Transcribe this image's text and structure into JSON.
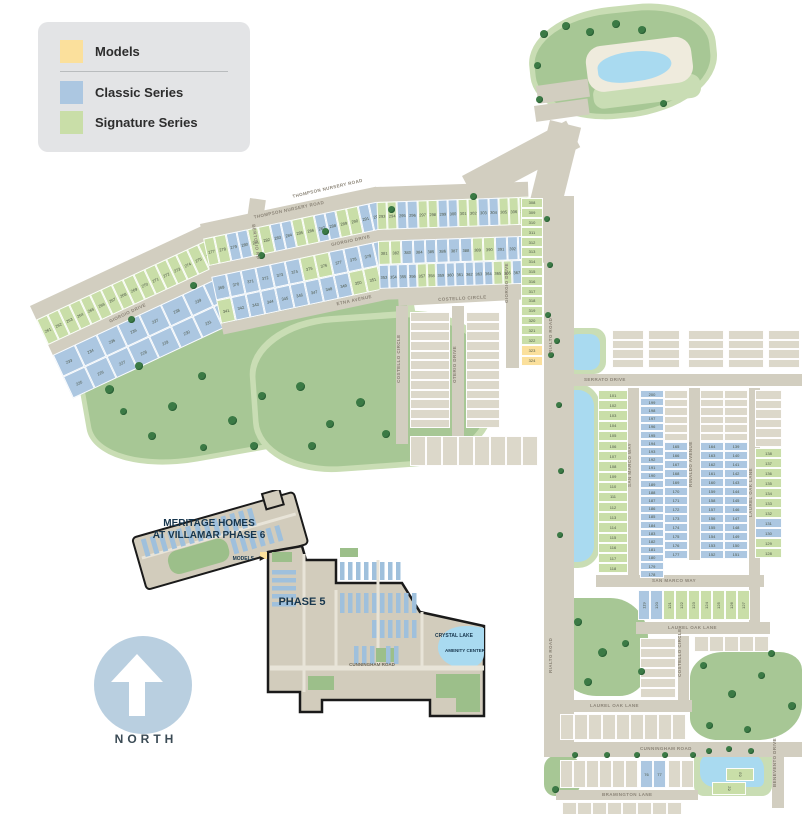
{
  "legend": {
    "items": [
      {
        "label": "Models",
        "series": "models"
      },
      {
        "label": "Classic Series",
        "series": "classic"
      },
      {
        "label": "Signature Series",
        "series": "signature"
      }
    ]
  },
  "north": {
    "label": "NORTH"
  },
  "colors": {
    "models": "#fbe09c",
    "classic": "#acc7e1",
    "signature": "#c9dea8",
    "future": "#dcd8ca",
    "road": "#d2cec0",
    "park": "#a7c795",
    "parklight": "#c9ddb4",
    "water": "#a9daf0",
    "tree": "#3b7a45",
    "navy": "#17364d",
    "road_label": "#8b8477",
    "lot_number": "#4b5545",
    "legend_bg": "#e3e4e6",
    "north_circle": "#b9cfe0"
  },
  "roads": {
    "thompson": "THOMPSON NURSERY ROAD",
    "giorgio": "GIORGIO DRIVE",
    "etna": "ETNA AVENUE",
    "bertolio": "BERTOLIO RD",
    "costello": "COSTELLO CIRCLE",
    "oterio": "OTERIO DRIVE",
    "rialto": "RIALTO ROAD",
    "serrato": "SERRATO DRIVE",
    "san_marco": "SAN MARCO WAY",
    "rinaldo": "RINALDO AVENUE",
    "laurel_oak": "LAUREL OAK LANE",
    "cunningham": "CUNNINGHAM ROAD",
    "bramington": "BRAMINGTON LANE",
    "benevento": "BENEVENTO DRIVE"
  },
  "amenity": {
    "center_label": "AMENITY CENTER",
    "pool_label": "POOL",
    "dog_park_label": "DOG PARK"
  },
  "inset": {
    "title1": "MERITAGE HOMES",
    "title2": "AT VILLAMAR PHASE 6",
    "models_label": "MODELS",
    "models_arrow": "▶",
    "phase5_label": "PHASE 5",
    "lake_label": "CRYSTAL LAKE",
    "amenity_label": "AMENITY CENTER",
    "road_label": "CUNNINGHAM ROAD"
  },
  "lot_strips": [
    {
      "id": "arcA",
      "series": "signature",
      "from": 261,
      "to": 276
    },
    {
      "id": "arcB",
      "series": "signature",
      "from": 277,
      "to": 292,
      "classic": [
        279,
        280,
        283,
        284,
        287,
        288,
        291,
        292
      ]
    },
    {
      "id": "arcC",
      "series": "signature",
      "from": 293,
      "to": 307,
      "classic": [
        295,
        296,
        299,
        300,
        303,
        304
      ]
    },
    {
      "id": "rowA2",
      "series": "classic",
      "from": 233,
      "to": 240
    },
    {
      "id": "rowA3",
      "series": "classic",
      "from": 225,
      "to": 232
    },
    {
      "id": "rowB2",
      "series": "classic",
      "from": 369,
      "to": 380,
      "signature": [
        375,
        376
      ]
    },
    {
      "id": "rowB3",
      "series": "classic",
      "from": 341,
      "to": 352,
      "signature": [
        341,
        350,
        351,
        352
      ]
    },
    {
      "id": "rowC2",
      "series": "classic",
      "from": 381,
      "to": 393,
      "signature": [
        381,
        382,
        389,
        390
      ]
    },
    {
      "id": "rowC3",
      "series": "classic",
      "from": 353,
      "to": 368,
      "signature": [
        357,
        358,
        365,
        366
      ]
    },
    {
      "id": "colGiorgio",
      "series": "signature",
      "from": 308,
      "to": 322
    },
    {
      "id": "colModels",
      "series": "models",
      "from": 323,
      "to": 324
    },
    {
      "id": "colW",
      "series": "signature",
      "from": 101,
      "to": 118
    },
    {
      "id": "col1L",
      "series": "classic",
      "from": 200,
      "to": 178
    },
    {
      "id": "col1R",
      "series": "classic",
      "from": 165,
      "to": 177
    },
    {
      "id": "col2L",
      "series": "classic",
      "from": 164,
      "to": 152
    },
    {
      "id": "col2R",
      "series": "classic",
      "from": 139,
      "to": 151
    },
    {
      "id": "colE",
      "series": "signature",
      "from": 138,
      "to": 128,
      "classic": [
        131,
        130
      ]
    },
    {
      "id": "rowSanMarco",
      "series": "signature",
      "from": 119,
      "to": 127,
      "classic": [
        119,
        120
      ]
    },
    {
      "id": "row7677",
      "series": "classic",
      "from": 76,
      "to": 77
    },
    {
      "id": "lot63",
      "series": "signature",
      "from": 63,
      "to": 63
    },
    {
      "id": "lot62",
      "series": "signature",
      "from": 62,
      "to": 62
    }
  ]
}
